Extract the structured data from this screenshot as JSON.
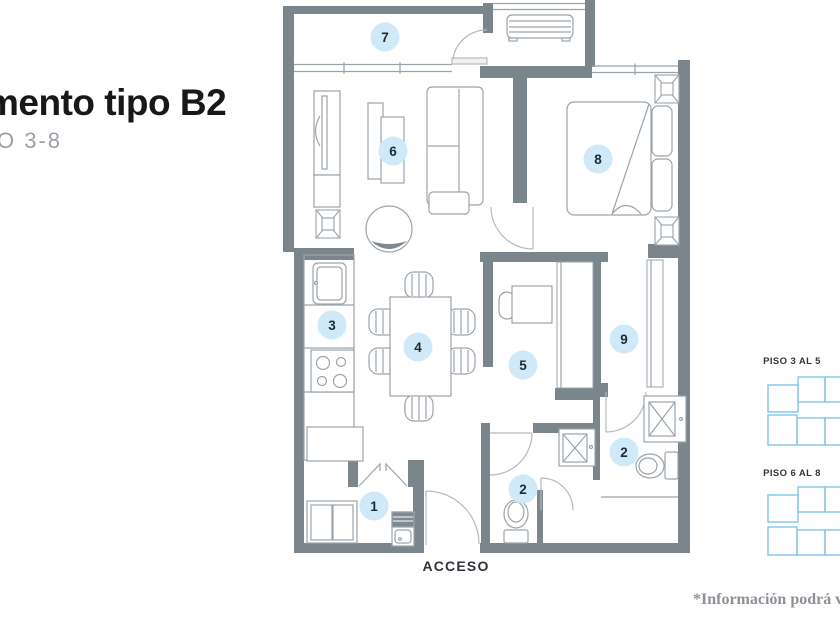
{
  "header": {
    "title_visible": "mento tipo B2",
    "subtitle_visible": "O 3-8"
  },
  "floorplan": {
    "acceso_label": "ACCESO",
    "room_markers": [
      {
        "number": "7",
        "x": 385,
        "y": 37
      },
      {
        "number": "6",
        "x": 393,
        "y": 151
      },
      {
        "number": "8",
        "x": 598,
        "y": 159
      },
      {
        "number": "3",
        "x": 332,
        "y": 325
      },
      {
        "number": "4",
        "x": 418,
        "y": 347
      },
      {
        "number": "5",
        "x": 523,
        "y": 365
      },
      {
        "number": "9",
        "x": 624,
        "y": 339
      },
      {
        "number": "2",
        "x": 624,
        "y": 452
      },
      {
        "number": "2",
        "x": 523,
        "y": 489
      },
      {
        "number": "1",
        "x": 374,
        "y": 506
      }
    ]
  },
  "floor_keys": [
    {
      "label": "PISO 3 AL 5"
    },
    {
      "label": "PISO 6 AL 8"
    }
  ],
  "footnote": "*Información podrá va",
  "colors": {
    "wall": "#7b858c",
    "furniture_line": "#9aa4ab",
    "door_line": "#b3bac0",
    "accent_dark": "#7f8990",
    "marker_fill": "#cfe9f8",
    "marker_text": "#1c2b36",
    "key_blue": "#82c5ea",
    "title_text": "#17181a",
    "subtitle_text": "#99a0a7",
    "acceso_text": "#2e3439",
    "footnote_text": "#8e9097"
  }
}
